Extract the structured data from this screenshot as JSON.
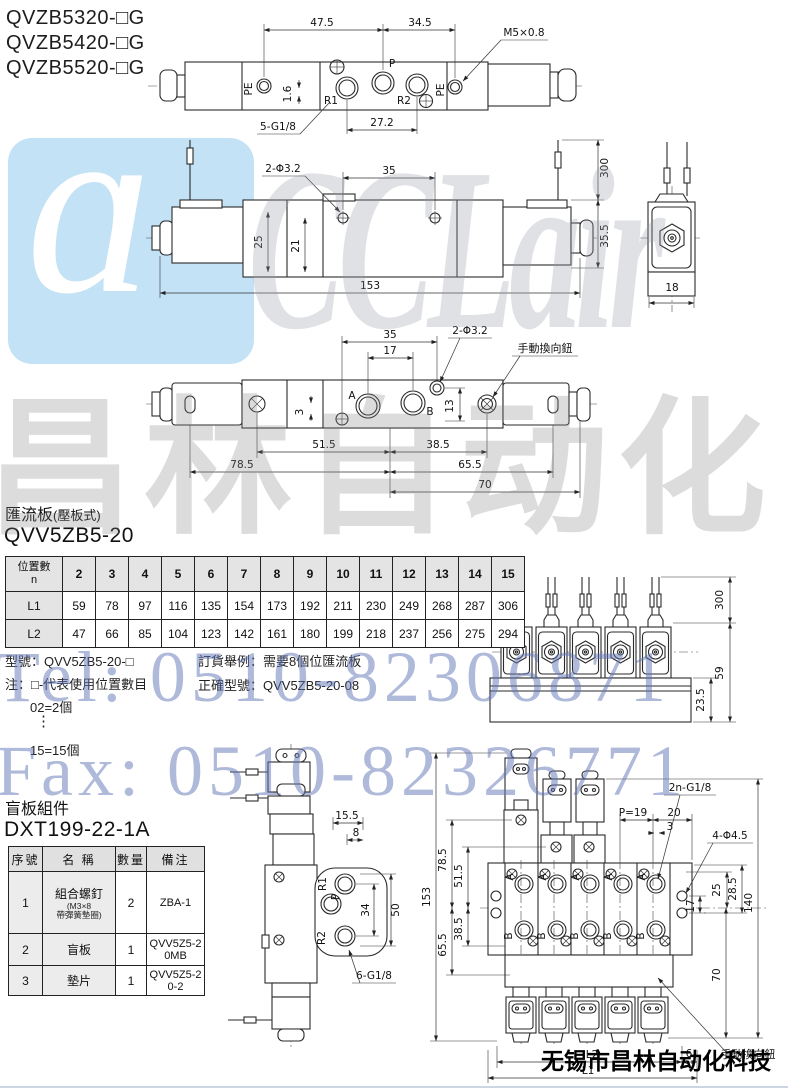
{
  "page": {
    "models": [
      "QVZB5320-□G",
      "QVZB5420-□G",
      "QVZB5520-□G"
    ],
    "company": "无锡市昌林自动化科技"
  },
  "watermarks": {
    "logo_mark": "ɑ",
    "logo": "CCLair",
    "cn": "昌林自动化",
    "tel": "Tel: 0510-82306871",
    "fax": "Fax: 0510-82326771",
    "blue": "#6074b6",
    "gray": "#9ca0a8",
    "logo_bg": "#c3e2f6"
  },
  "top_view": {
    "d475": "47.5",
    "d345": "34.5",
    "m5": "M5×0.8",
    "pe_l": "PE",
    "pe_r": "PE",
    "p": "P",
    "r1": "R1",
    "r2": "R2",
    "d16": "1.6",
    "g18": "5-G1/8",
    "d272": "27.2"
  },
  "side_view": {
    "phi": "2-Φ3.2",
    "d35": "35",
    "d300": "300",
    "d25": "25",
    "d21": "21",
    "d153": "153",
    "d355": "35.5",
    "d18": "18"
  },
  "bottom_view": {
    "d35": "35",
    "d17": "17",
    "phi": "2-Φ3.2",
    "manual": "手動換向鈕",
    "a": "A",
    "b": "B",
    "d3": "3",
    "d13": "13",
    "d515": "51.5",
    "d385": "38.5",
    "d785": "78.5",
    "d655": "65.5",
    "d70": "70"
  },
  "manifold_section": {
    "title": "匯流板",
    "title_sub": "(壓板式)",
    "model": "QVV5ZB5-20",
    "table": {
      "corner_top": "位置數",
      "corner_bottom": "n",
      "l1": "L1",
      "l2": "L2",
      "positions": [
        "2",
        "3",
        "4",
        "5",
        "6",
        "7",
        "8",
        "9",
        "10",
        "11",
        "12",
        "13",
        "14",
        "15"
      ],
      "l1_values": [
        "59",
        "78",
        "97",
        "116",
        "135",
        "154",
        "173",
        "192",
        "211",
        "230",
        "249",
        "268",
        "287",
        "306"
      ],
      "l2_values": [
        "47",
        "66",
        "85",
        "104",
        "123",
        "142",
        "161",
        "180",
        "199",
        "218",
        "237",
        "256",
        "275",
        "294"
      ]
    },
    "note1": "型號：QVV5ZB5-20-□",
    "note2": "注：□-代表使用位置數目",
    "note3": "02=2個",
    "note4": "⋮",
    "note5": "15=15個",
    "order1": "訂貨舉例：需要8個位匯流板",
    "order2": "正確型號：QVV5ZB5-20-08",
    "front": {
      "d300": "300",
      "d59": "59",
      "d235": "23.5"
    }
  },
  "blank_section": {
    "title": "盲板組件",
    "model": "DXT199-22-1A",
    "table": {
      "h1": "序號",
      "h2": "名 稱",
      "h3": "數量",
      "h4": "備注",
      "r1": {
        "no": "1",
        "name": "組合螺釘",
        "sub1": "(M3×8",
        "sub2": "帶彈簧墊圈)",
        "qty": "2",
        "remark": "ZBA-1"
      },
      "r2": {
        "no": "2",
        "name": "盲板",
        "qty": "1",
        "remark": "QVV5Z5-20MB"
      },
      "r3": {
        "no": "3",
        "name": "墊片",
        "qty": "1",
        "remark": "QVV5Z5-20-2"
      }
    }
  },
  "single_view": {
    "d155": "15.5",
    "d8": "8",
    "r1": "R1",
    "p": "P",
    "r2": "R2",
    "d34": "34",
    "d50": "50",
    "g": "6-G1/8"
  },
  "assembly_view": {
    "g": "2n-G1/8",
    "p19": "P=19",
    "d20": "20",
    "d3": "3",
    "phi": "4-Φ4.5",
    "d785": "78.5",
    "d515": "51.5",
    "d153": "153",
    "d385": "38.5",
    "d655": "65.5",
    "d25": "25",
    "d285": "28.5",
    "d17": "17",
    "d140": "140",
    "d70": "70",
    "l1": "L1",
    "l2": "L2",
    "d6": "6",
    "manual": "手動換向鈕",
    "a": "A",
    "b": "B"
  }
}
